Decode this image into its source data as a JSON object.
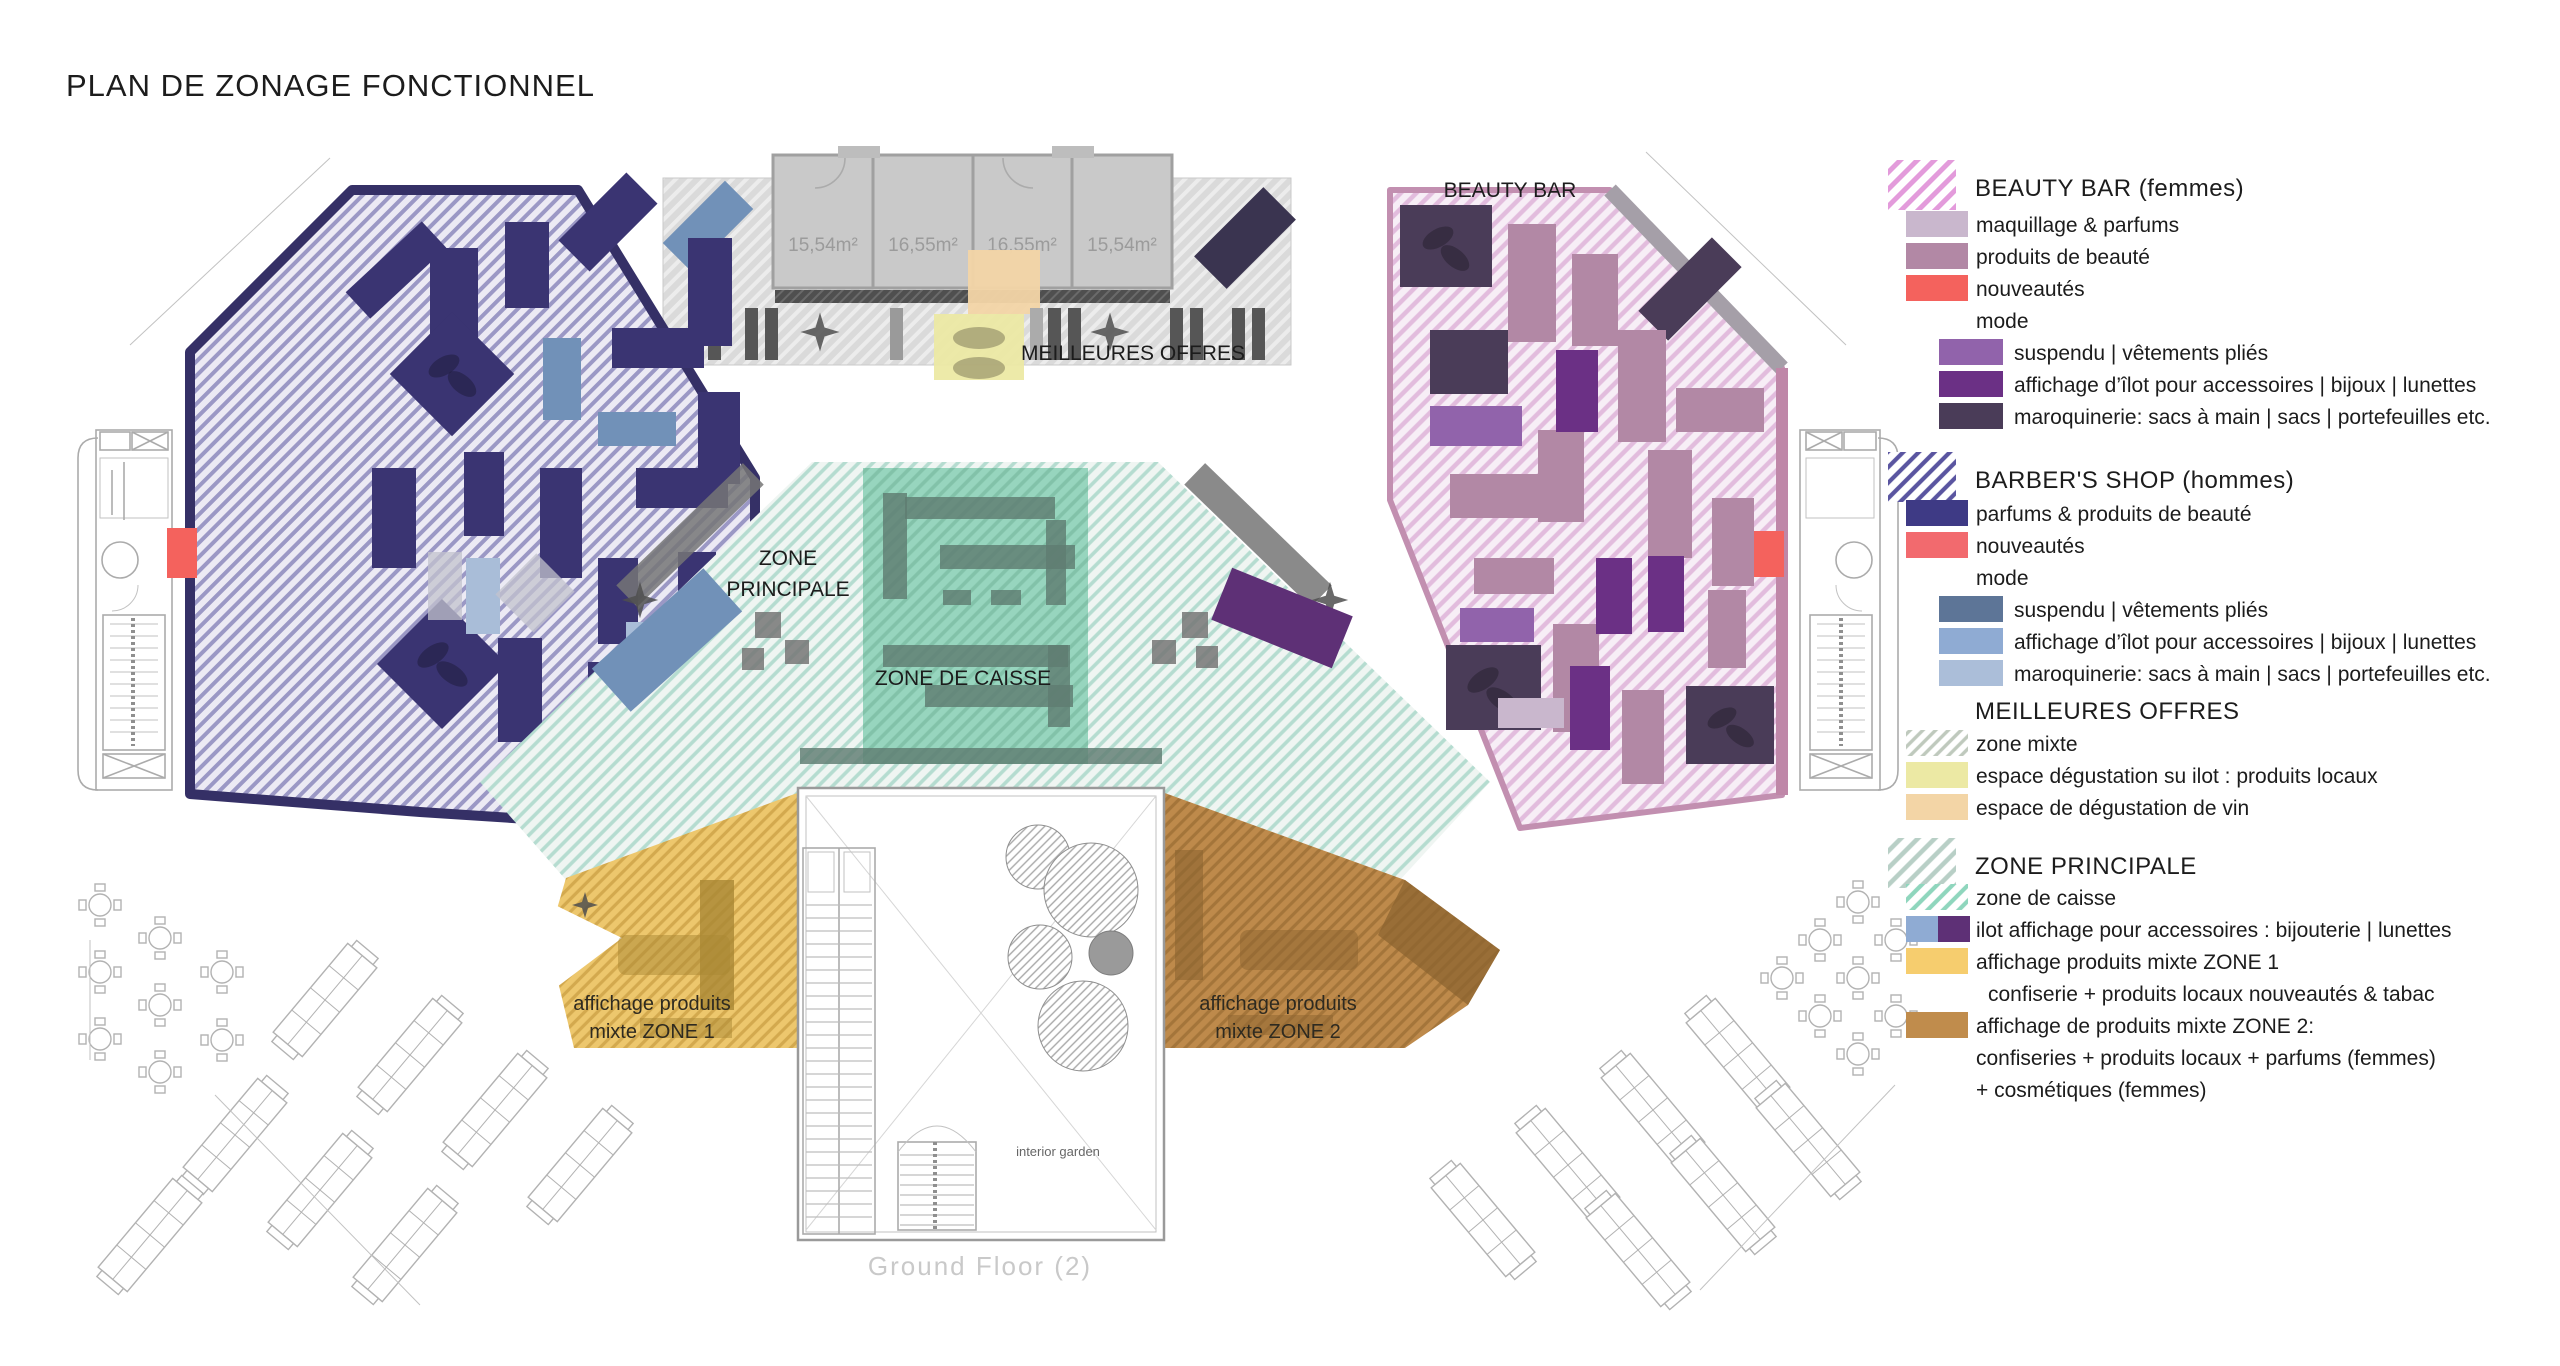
{
  "title": "PLAN DE ZONAGE FONCTIONNEL",
  "plan": {
    "labels": {
      "beauty_bar": "BEAUTY BAR",
      "meilleures_offres": "MEILLEURES OFFRES",
      "zone_principale_1": "ZONE",
      "zone_principale_2": "PRINCIPALE",
      "zone_de_caisse": "ZONE DE CAISSE",
      "zone1_1": "affichage produits",
      "zone1_2": "mixte ZONE 1",
      "zone2_1": "affichage produits",
      "zone2_2": "mixte ZONE 2",
      "interior_garden": "interior garden",
      "ground_floor": "Ground Floor (2)"
    },
    "room_areas": [
      "15,54m²",
      "16,55m²",
      "16,55m²",
      "15,54m²"
    ]
  },
  "legend": {
    "sections": [
      {
        "header": "BEAUTY BAR (femmes)",
        "swatch": "hatch-pink",
        "items": [
          {
            "label": "maquillage & parfums",
            "color": "#C9B7CD"
          },
          {
            "label": "produits de beauté",
            "color": "#B288A5"
          },
          {
            "label": "nouveautés",
            "color": "#F4625D"
          },
          {
            "label": "mode",
            "color": null
          },
          {
            "label": "suspendu | vêtements pliés",
            "color": "#9163AB"
          },
          {
            "label": "affichage d’îlot pour accessoires | bijoux | lunettes",
            "color": "#6B3085"
          },
          {
            "label": "maroquinerie: sacs à main | sacs | portefeuilles etc.",
            "color": "#4A3C58"
          }
        ]
      },
      {
        "header": "BARBER'S SHOP (hommes)",
        "swatch": "hatch-navy",
        "items": [
          {
            "label": "parfums & produits de beauté",
            "color": "#3E3A85"
          },
          {
            "label": "nouveautés",
            "color": "#F26A6E"
          },
          {
            "label": "mode",
            "color": null
          },
          {
            "label": "suspendu | vêtements pliés",
            "color": "#5D7597"
          },
          {
            "label": "affichage d’îlot pour accessoires | bijoux | lunettes",
            "color": "#8FABD3"
          },
          {
            "label": "maroquinerie: sacs à main | sacs | portefeuilles etc.",
            "color": "#ABBED9"
          }
        ]
      },
      {
        "header": "MEILLEURES OFFRES",
        "swatch": null,
        "items": [
          {
            "label": "zone mixte",
            "color": "hatch-graygreen"
          },
          {
            "label": "espace dégustation su ilot : produits locaux",
            "color": "#ECE9A4"
          },
          {
            "label": "espace de dégustation de vin",
            "color": "#F3D5A6"
          }
        ]
      },
      {
        "header": "ZONE PRINCIPALE",
        "swatch": "hatch-teal",
        "items": [
          {
            "label": "zone de caisse",
            "color": "hatch-mint"
          },
          {
            "label": "ilot affichage pour accessoires : bijouterie | lunettes",
            "color": "#8FABD3 | #5E3076"
          },
          {
            "label": "affichage produits mixte ZONE 1",
            "color": "#F6CD6E"
          },
          {
            "label": "confiserie + produits locaux nouveautés & tabac",
            "color": null
          },
          {
            "label": "affichage de produits mixte ZONE 2:",
            "color": "#C08C4C"
          },
          {
            "label": "confiseries + produits locaux + parfums (femmes)",
            "color": null
          },
          {
            "label": "+ cosmétiques (femmes)",
            "color": null
          }
        ]
      }
    ]
  },
  "colors": {
    "barber_wing_hatch": "#9B98C5",
    "beauty_wing_hatch": "#E2BCDD",
    "gray_zone": "#DCDCDC",
    "zone_principale_hatch": "#AEDCCD",
    "zone_caisse": "#8FD2B9",
    "zone1_gold": "#EDC76D",
    "zone2_brown": "#BE8A4B",
    "nouveautes_red": "#F4625D",
    "degustation_yellow": "#ECE9A4",
    "degustation_vin_tan": "#F3D5A6"
  }
}
